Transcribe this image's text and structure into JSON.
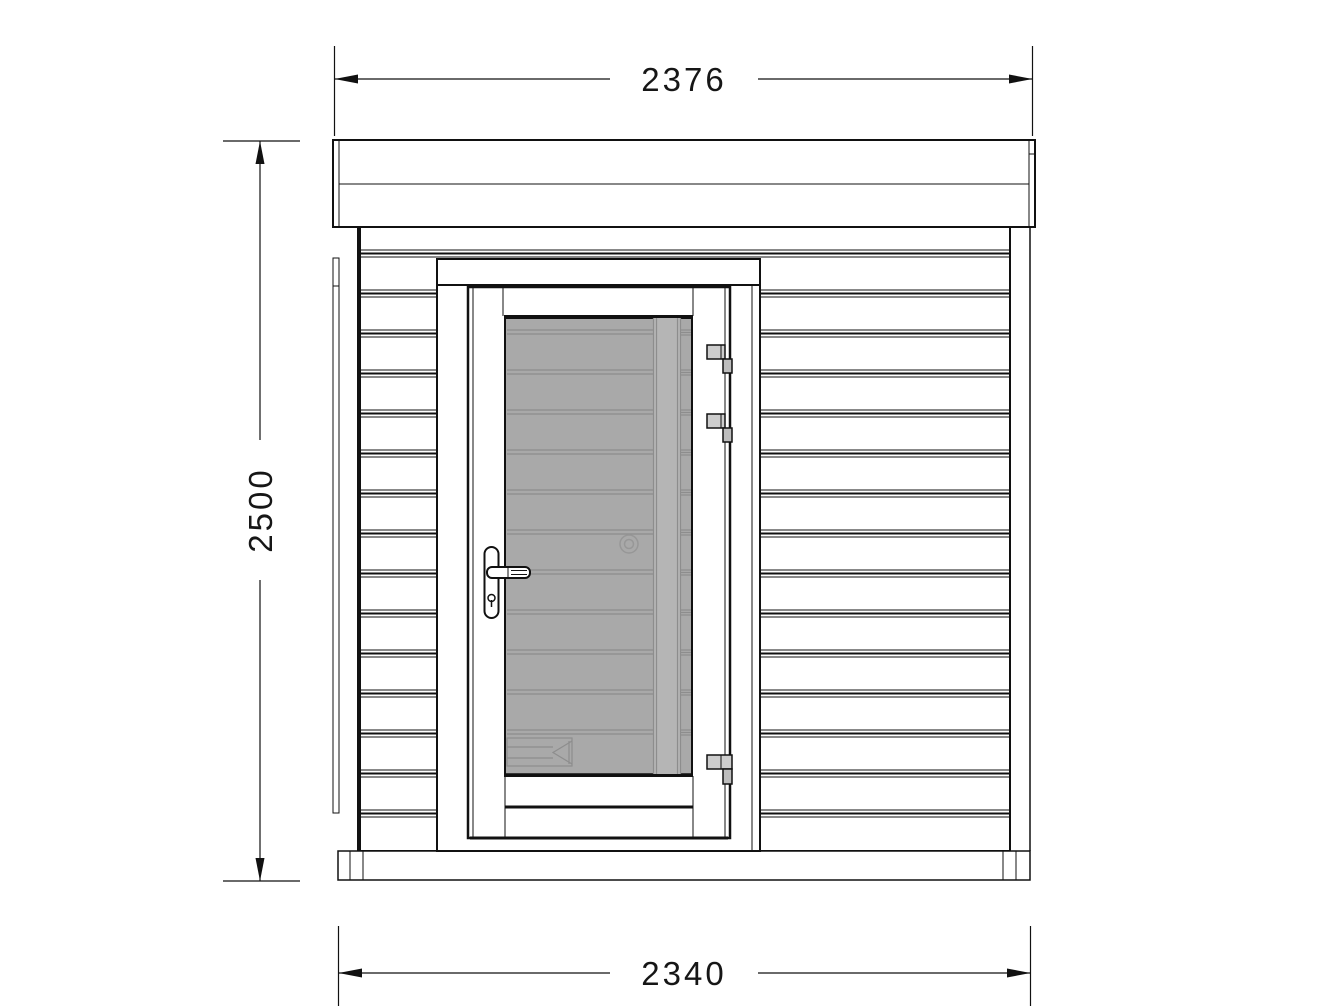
{
  "drawing_title": "Shed front elevation",
  "dimensions": {
    "width_top": {
      "value": "2376"
    },
    "height_left": {
      "value": "2500"
    },
    "width_bottom": {
      "value": "2340"
    }
  },
  "colors": {
    "background": "#ffffff",
    "line": "#111111",
    "glass": "#a9a9a9",
    "glass_band": "#b5b5b5",
    "glass_detail_line": "#8d8d8d",
    "hinge_plate": "#cdcdcd",
    "hinge_knuckle": "#bdbdbd"
  }
}
